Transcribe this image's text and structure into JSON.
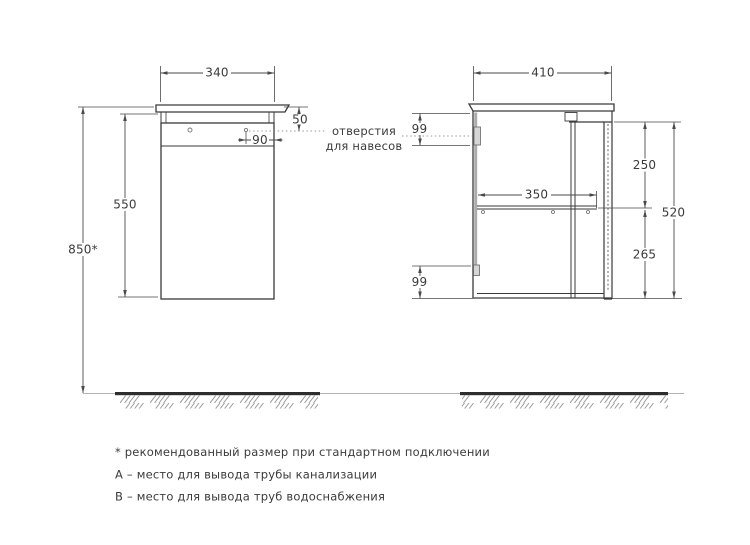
{
  "drawing": {
    "front_view": {
      "dims": {
        "top_width": "340",
        "top_to_holes": "50",
        "hole_to_edge": "90",
        "body_height": "550",
        "floor_to_top": "850*"
      }
    },
    "side_view": {
      "dims": {
        "depth": "410",
        "holes_top_offset": "99",
        "top_to_shelf": "250",
        "shelf_depth": "350",
        "carcass_height": "520",
        "shelf_to_bottom": "265",
        "bottom_holes_offset": "99"
      }
    },
    "annotations": {
      "hanger_holes_line1": "отверстия",
      "hanger_holes_line2": "для навесов"
    },
    "footnotes": [
      "* рекомендованный размер при стандартном подключении",
      "А – место для вывода трубы канализации",
      "В – место для вывода труб водоснабжения"
    ],
    "colors": {
      "outline": "#3a3a3a",
      "dimension": "#4a4a4a",
      "text": "#3b3b3b",
      "floor": "#2d2d2d",
      "hatch": "#9b9b9b",
      "back_panel_grey": "#acacac"
    }
  }
}
